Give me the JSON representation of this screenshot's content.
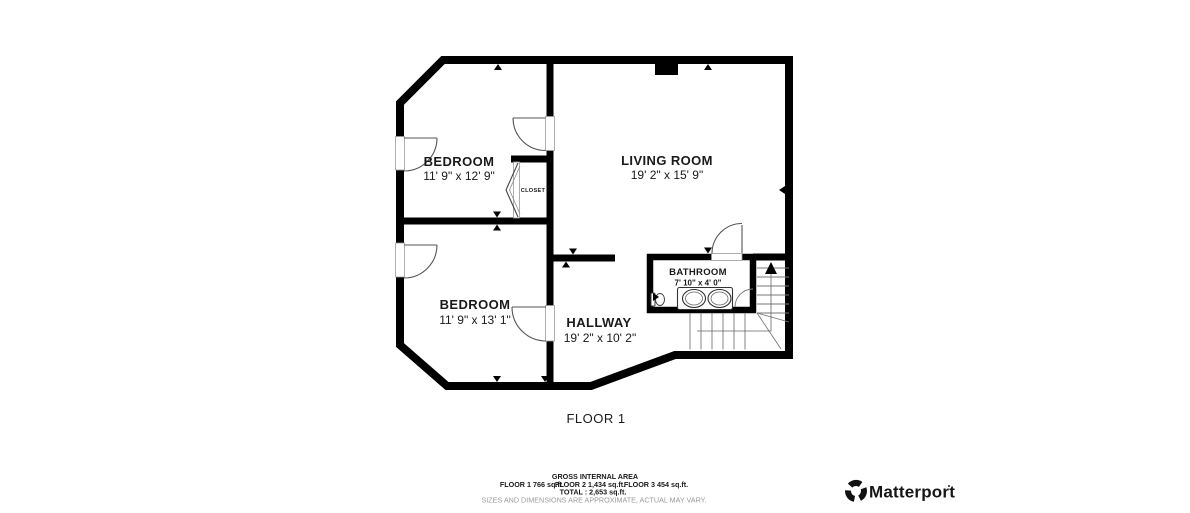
{
  "floor_plan": {
    "floor_label": "FLOOR 1",
    "rooms": {
      "bedroom1": {
        "name": "BEDROOM",
        "dims": "11' 9\" x 12' 9\""
      },
      "living": {
        "name": "LIVING ROOM",
        "dims": "19' 2\" x 15' 9\""
      },
      "bedroom2": {
        "name": "BEDROOM",
        "dims": "11' 9\" x 13' 1\""
      },
      "hallway": {
        "name": "HALLWAY",
        "dims": "19' 2\" x 10' 2\""
      },
      "bathroom": {
        "name": "BATHROOM",
        "dims": "7' 10\" x 4' 0\""
      },
      "closet": {
        "name": "CLOSET"
      }
    }
  },
  "footer": {
    "gross_title": "GROSS INTERNAL AREA",
    "floor1_area": "FLOOR 1 766 sq.ft.",
    "floor2_area": "FLOOR 2 1,434 sq.ft.",
    "floor3_area": "FLOOR 3 454 sq.ft.",
    "total": "TOTAL :  2,653 sq.ft.",
    "disclaimer": "SIZES AND DIMENSIONS ARE APPROXIMATE, ACTUAL MAY VARY."
  },
  "brand": {
    "name": "Matterport"
  },
  "colors": {
    "wall": "#000000",
    "text": "#1a1a1a",
    "muted": "#9a9a9a",
    "background": "#ffffff"
  }
}
